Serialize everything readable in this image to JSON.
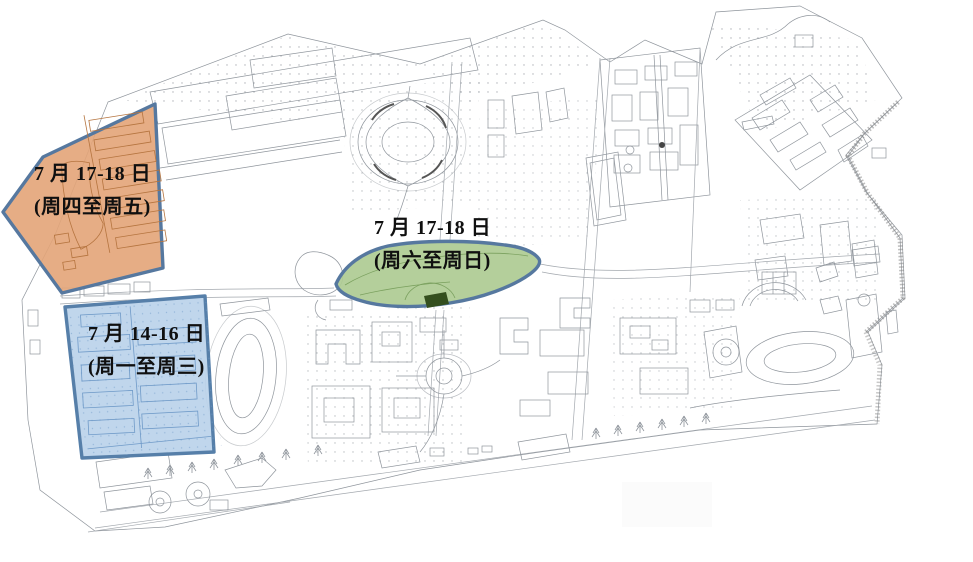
{
  "map": {
    "background": "#ffffff",
    "linework_color": "#8f959c",
    "label_color": "#101010"
  },
  "regions": [
    {
      "id": "northwest-dorm-zone",
      "date_label": "7 月 17-18 日",
      "weekday_label": "(周四至周五)",
      "fill": "#E3A478",
      "border": "#56789F",
      "inner_line_color": "#b5743f"
    },
    {
      "id": "central-park-zone",
      "date_label": "7 月 17-18 日",
      "weekday_label": "(周六至周日)",
      "fill": "#AECB92",
      "border": "#56789F",
      "inner_line_color": "#7aa05e",
      "dark_feature_fill": "#344F1E"
    },
    {
      "id": "southwest-dorm-zone",
      "date_label": "7 月 14-16 日",
      "weekday_label": "(周一至周三)",
      "fill": "#B9D2EA",
      "border": "#567FA9",
      "inner_line_color": "#6f9ac8"
    }
  ]
}
